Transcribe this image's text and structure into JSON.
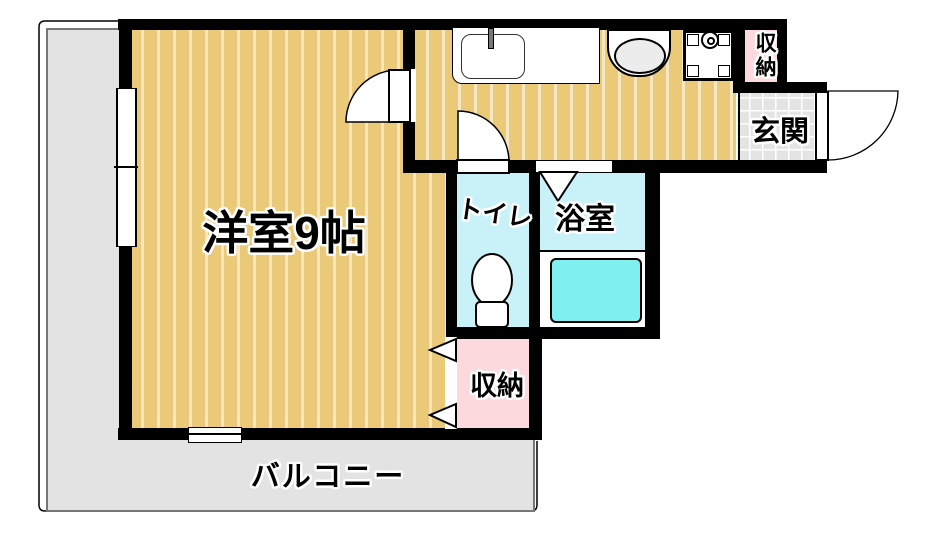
{
  "plan_title": "floor-plan",
  "rooms": {
    "main_room": {
      "label": "洋室9帖"
    },
    "toilet": {
      "label": "トイレ"
    },
    "bathroom": {
      "label": "浴室"
    },
    "entrance": {
      "label": "玄関"
    },
    "storage_top": {
      "label": "収納"
    },
    "storage_bottom": {
      "label": "収納"
    },
    "balcony": {
      "label": "バルコニー"
    }
  },
  "fixtures": [
    "kitchen-sink",
    "washbasin",
    "washing-machine-pan",
    "toilet-bowl",
    "bathtub",
    "entrance-door",
    "room-door",
    "hall-door",
    "folding-door",
    "sliding-window",
    "storage-doors"
  ],
  "colors": {
    "wall": "#000000",
    "wood_floor": "#eac979",
    "wood_stripe": "#f6e8bd",
    "wet_room": "#c9f2f8",
    "bathtub": "#80efef",
    "storage_pink": "#fbd9dd",
    "entrance_tile": "#e4e4e4",
    "balcony_gray": "#e3e3e3"
  }
}
